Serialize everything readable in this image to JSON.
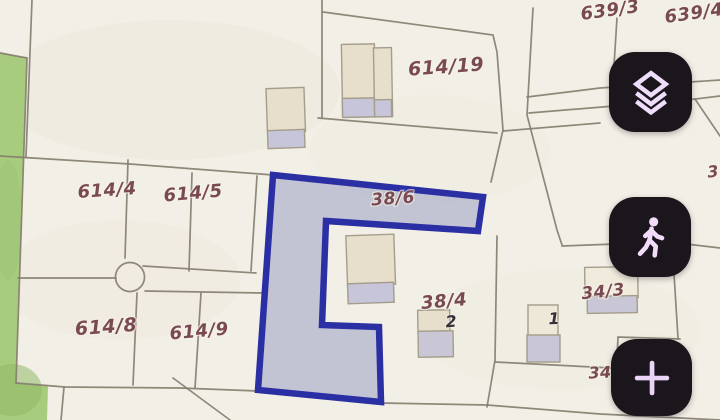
{
  "map": {
    "type": "cadastral-parcel-map",
    "labels": [
      {
        "text": "639/3"
      },
      {
        "text": "639/4"
      },
      {
        "text": "614/19"
      },
      {
        "text": "614/4"
      },
      {
        "text": "614/5"
      },
      {
        "text": "38/6"
      },
      {
        "text": "38/4"
      },
      {
        "text": "34/3"
      },
      {
        "text": "614/8"
      },
      {
        "text": "614/9"
      },
      {
        "text": "2"
      },
      {
        "text": "1"
      },
      {
        "text": "34"
      },
      {
        "text": "3"
      }
    ],
    "highlighted_parcel": {
      "label": "38/6",
      "fill": "#9aa0c4",
      "stroke": "#2b2fa4"
    },
    "colors": {
      "background": "#f2efe6",
      "parcel_lines": "#867f70",
      "label_text": "#7a4a52",
      "house_number_text": "#38313a",
      "green_area": "#a8cc7d",
      "building_tan": "#e7dfcb",
      "building_gray": "#c7c5d9"
    }
  },
  "toolbar": {
    "buttons": [
      {
        "name": "layers",
        "icon": "layers-icon"
      },
      {
        "name": "walk-mode",
        "icon": "pedestrian-icon"
      },
      {
        "name": "zoom-in",
        "icon": "plus-icon"
      }
    ],
    "button_bg": "#1a161c",
    "icon_color": "#eeddfb"
  }
}
